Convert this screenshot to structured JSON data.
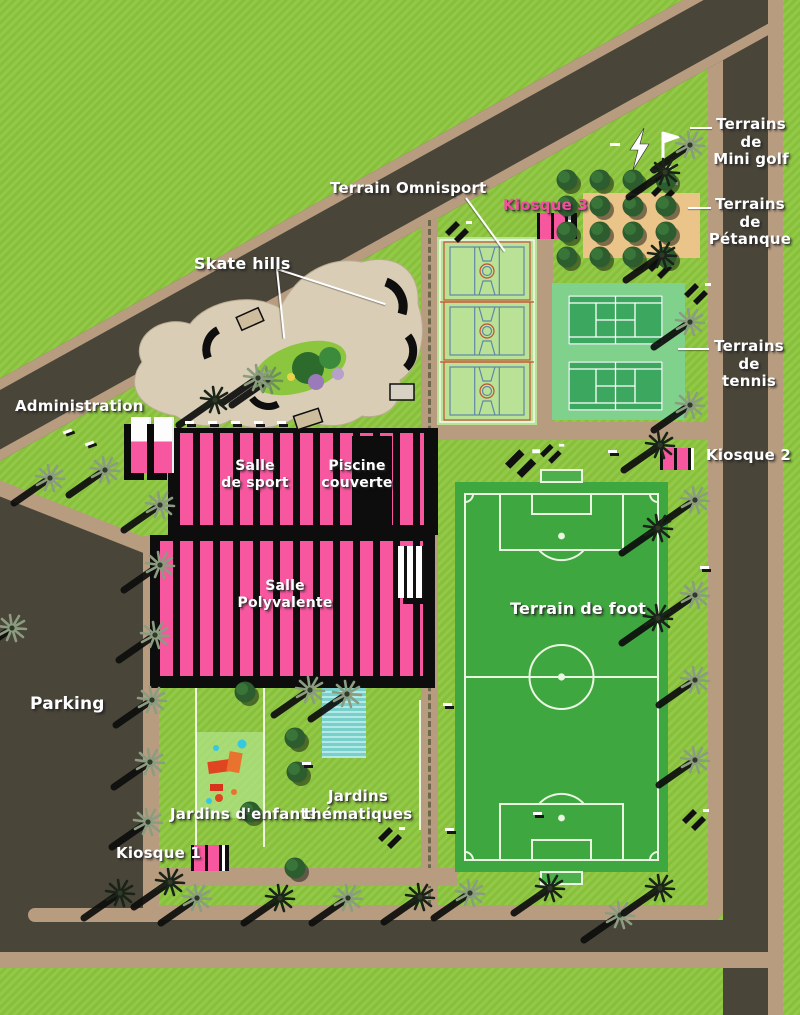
{
  "title": "Plan d'aménagement du parc des sports",
  "palette": {
    "grass": "#8CC63E",
    "road": "#4A4539",
    "sidewalk": "#B79C80",
    "sand": "#EAC489",
    "skate_paving": "#D9CDB5",
    "building_pink": "#F6579F",
    "omnisport_green": "#B9E297",
    "tennis_surround": "#7FD18C",
    "tennis_court": "#3BA75F",
    "foot_green": "#3FA73F",
    "pool_blue": "#8ADFDA",
    "label_white": "#FFFFFF",
    "label_pink": "#F0509D",
    "court_line_blue": "#5F87A8",
    "court_line_red": "#C3502E",
    "tree_dark": "#2D5C2E",
    "palm_gray": "#8B9C80"
  },
  "labels": {
    "terrain_omnisport": "Terrain Omnisport",
    "skate_hills": "Skate hills",
    "kiosque_3": "Kiosque 3",
    "mini_golf": "Terrains\nde\nMini golf",
    "petanque": "Terrains\nde\nPétanque",
    "tennis": "Terrains\nde\ntennis",
    "kiosque_2": "Kiosque 2",
    "administration": "Administration",
    "salle_de_sport": "Salle\nde sport",
    "piscine_couverte": "Piscine\ncouverte",
    "salle_polyvalente": "Salle\nPolyvalente",
    "terrain_de_foot": "Terrain de foot",
    "parking": "Parking",
    "jardins_enfants": "Jardins d'enfants",
    "jardins_thematiques": "Jardins\nthématiques",
    "kiosque_1": "Kiosque 1"
  },
  "icons": {
    "mini_golf_lightning": "lightning-icon",
    "mini_golf_flag": "golf-flag-icon",
    "palm": "palm-tree-icon",
    "round_tree": "round-tree-icon",
    "stairs": "stairs-icon",
    "bench": "bench-marker"
  }
}
